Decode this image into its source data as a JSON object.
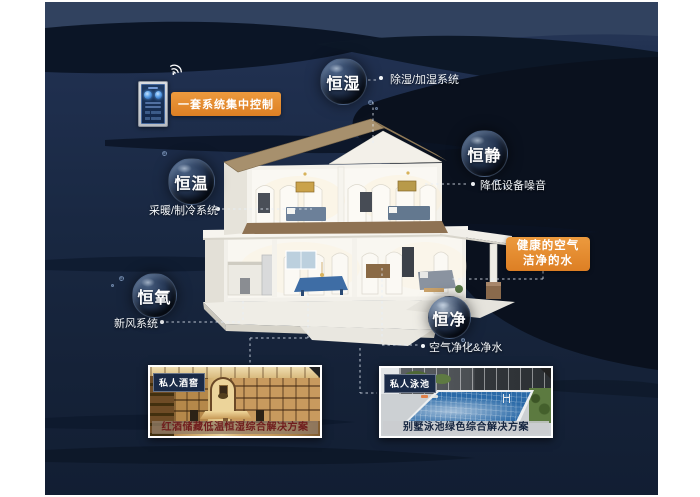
{
  "scene": {
    "colors": {
      "canvas_navy": "#192842",
      "wave_dark": "#0a111e",
      "accent_orange": "#e0882f",
      "label_text": "#ffffff"
    }
  },
  "badges": {
    "central_control": "一套系统集中控制",
    "healthy": {
      "line1": "健康的空气",
      "line2": "洁净的水"
    }
  },
  "bubbles": [
    {
      "label": "恒湿"
    },
    {
      "label": "恒静"
    },
    {
      "label": "恒温"
    },
    {
      "label": "恒氧"
    },
    {
      "label": "恒净"
    }
  ],
  "callouts": {
    "humidity": "除湿/加湿系统",
    "quiet": "降低设备噪音",
    "temperature": "采暖/制冷系统",
    "oxygen": "新风系统",
    "purity": "空气净化&净水"
  },
  "cards": [
    {
      "tag": "私人酒窖",
      "caption": "红酒储藏低温恒湿综合解决方案"
    },
    {
      "tag": "私人泳池",
      "caption": "别墅泳池绿色综合解决方案"
    }
  ]
}
